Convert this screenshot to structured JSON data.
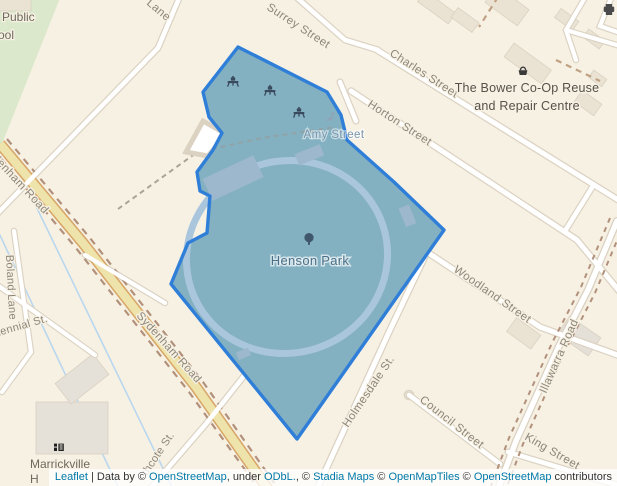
{
  "map": {
    "park": {
      "name": "Henson Park",
      "tree_icon": "tree-icon"
    },
    "streets": {
      "lane_fragment": "Lane",
      "surrey": "Surrey Street",
      "charles": "Charles Street",
      "horton": "Horton Street",
      "amy": "Amy Street",
      "woodland": "Woodland Street",
      "illawarra": "Illawarra Road",
      "sydenham": "Sydenham Road",
      "boland": "Boland Lane",
      "centennial_fragment": "tennial St.",
      "northcote_fragment": "thcote St.",
      "holmesdale": "Holmesdale St.",
      "council": "Council Street",
      "king": "King Street"
    },
    "pois": {
      "bower_line1": "The Bower Co-Op Reuse",
      "bower_line2": "and Repair Centre",
      "school_fragment_line1": "Public",
      "school_fragment_line2": "ool",
      "marrickville": "Marrickville",
      "high_school_fragment": "H"
    },
    "colors": {
      "land": "#f7f1e4",
      "school_green": "#dbe8cb",
      "road_fill": "#ffffff",
      "road_casing": "#dbd2c2",
      "main_road_fill": "#eee3ab",
      "main_road_casing": "#d7a567",
      "route_dashes": "#b2917b",
      "overlay_fill": "#84b1c1",
      "overlay_stroke": "#2f7ed8",
      "oval_track": "#aac6dd",
      "waterway": "#b9d7ee",
      "icon_dark": "#394a5e"
    }
  },
  "attribution": {
    "segments": [
      {
        "t": "Leaflet",
        "link": true
      },
      {
        "t": " | ",
        "link": false
      },
      {
        "t": "Data by © ",
        "link": false
      },
      {
        "t": "OpenStreetMap",
        "link": true
      },
      {
        "t": ", under ",
        "link": false
      },
      {
        "t": "ODbL.",
        "link": true
      },
      {
        "t": ", © ",
        "link": false
      },
      {
        "t": "Stadia Maps",
        "link": true
      },
      {
        "t": " © ",
        "link": false
      },
      {
        "t": "OpenMapTiles",
        "link": true
      },
      {
        "t": " © ",
        "link": false
      },
      {
        "t": "OpenStreetMap",
        "link": true
      },
      {
        "t": " contributors",
        "link": false
      }
    ]
  }
}
